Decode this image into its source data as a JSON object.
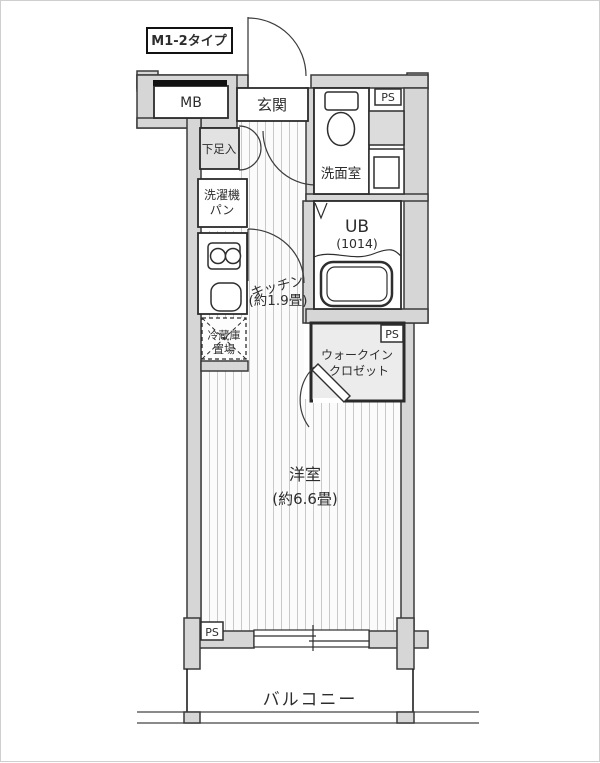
{
  "plan": {
    "type_label": "M1-2タイプ",
    "labels": {
      "mb": "MB",
      "genkan": "玄関",
      "shoe_box": "下足入",
      "washer_pan_1": "洗濯機",
      "washer_pan_2": "パン",
      "washroom": "洗面室",
      "ps": "PS",
      "ub": "UB",
      "ub_size": "(1014)",
      "kitchen": "キッチン",
      "kitchen_size": "(約1.9畳)",
      "fridge_1": "冷蔵庫",
      "fridge_2": "置場",
      "wic_1": "ウォークイン",
      "wic_2": "クロゼット",
      "western_room": "洋室",
      "western_room_size": "(約6.6畳)",
      "balcony": "バルコニー"
    },
    "colors": {
      "wall": "#d6d6d6",
      "wall_line": "#3b3b3b",
      "closet_fill": "#ececec",
      "floor_stripe": "#c9c9c9"
    }
  }
}
